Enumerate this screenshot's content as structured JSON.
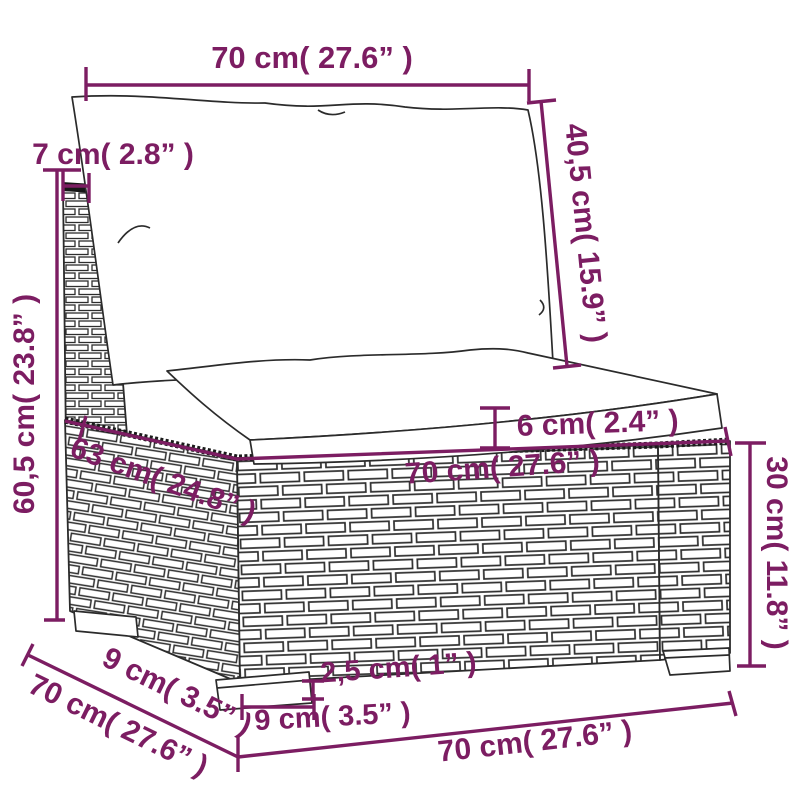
{
  "diagram": {
    "type": "furniture-dimension-diagram",
    "subject": "poly-rattan-sofa-middle-section-with-cushions",
    "colors": {
      "dimension": "#7c1d62",
      "line_art": "#2b2b2b",
      "background": "#ffffff"
    },
    "dimensions": {
      "top_width": "70 cm( 27.6” )",
      "post_top_depth": "7 cm( 2.8” )",
      "backrest_height": "60,5 cm( 23.8” )",
      "back_cushion_height": "40,5 cm( 15.9” )",
      "seat_cushion_thickness": "6 cm( 2.4” )",
      "seat_front_width": "70 cm( 27.6” )",
      "seat_depth": "63 cm( 24.8” )",
      "base_height": "30 cm( 11.8” )",
      "foot_height": "2,5 cm( 1” )",
      "foot_width": "9 cm( 3.5” )",
      "side_foot_depth": "9 cm( 3.5” )",
      "side_depth": "70 cm( 27.6” )",
      "bottom_front_width": "70 cm( 27.6” )"
    }
  }
}
